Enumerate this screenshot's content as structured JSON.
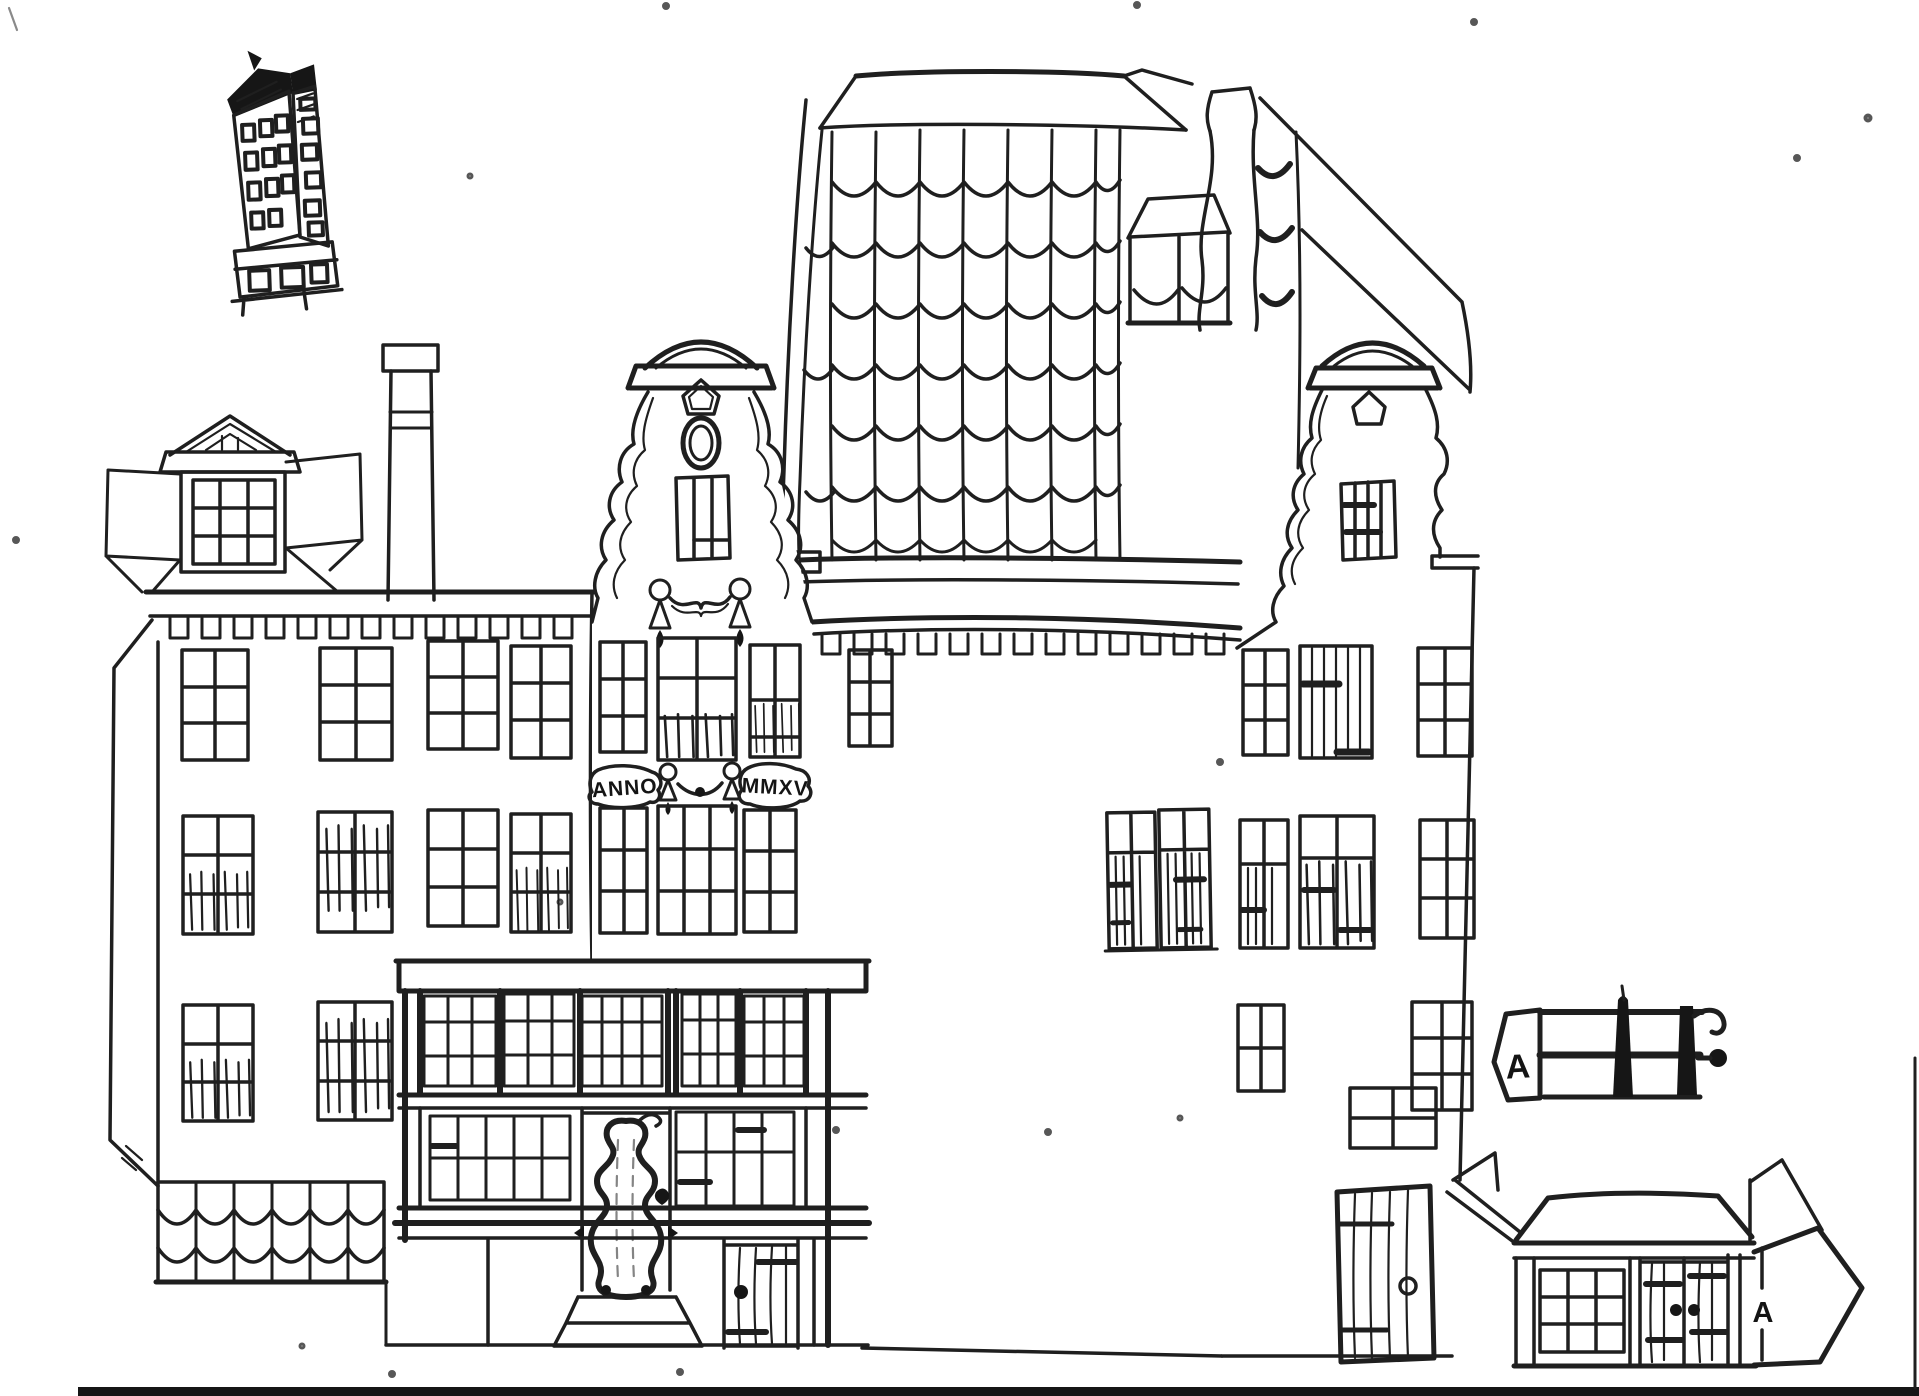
{
  "drawing": {
    "banners": {
      "anno": "ANNO",
      "year": "MMXV"
    },
    "part_labels": {
      "hoisting_beam": "A",
      "annex": "A"
    }
  },
  "colors": {
    "ink": "#1f1f1f",
    "paper": "#ffffff",
    "scan_margin": "#e9e9e9",
    "scan_bar": "#0d0d0d"
  }
}
